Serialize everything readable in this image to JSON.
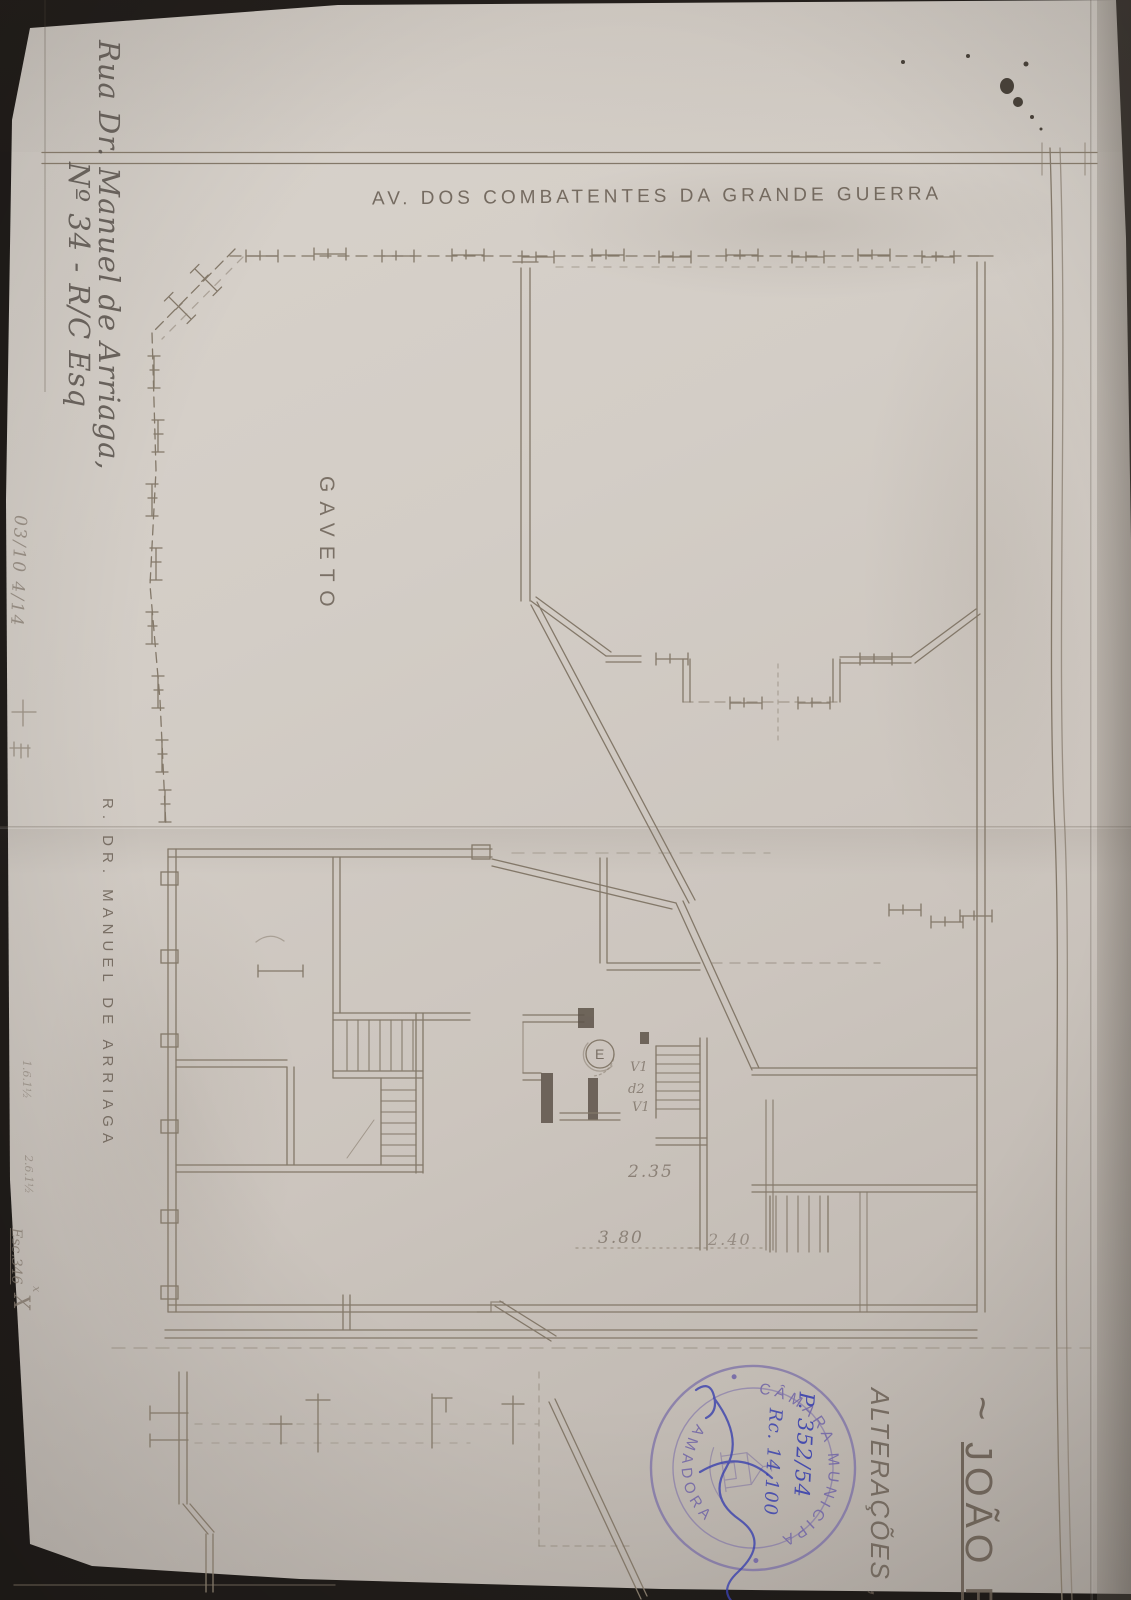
{
  "drawing": {
    "street_top": "AV. DOS COMBATENTES DA GRANDE GUERRA",
    "corner_label": "GAVETO",
    "street_left": "R. DR. MANUEL DE ARRIAGA",
    "room_labels": {
      "entry": "E",
      "window_top": "V1",
      "door_mid": "d2",
      "window_bottom": "V1"
    },
    "dimensions": {
      "hall": "2.35",
      "room": "3.80",
      "stair": "2.40"
    }
  },
  "handwriting": {
    "address_line1": "Rua Dr. Manuel de Arriaga,",
    "address_line2": "Nº 34 - R/C Esq",
    "margin_top_note": "03/10 4/14",
    "margin_note_1": "1.6.1½",
    "margin_note_2": "2.6.1½",
    "margin_scale_note": "Esc.346",
    "margin_mark": "X",
    "margin_mark_small": "x"
  },
  "titles": {
    "tilde": "~",
    "owner_name": "JOÃO RIC",
    "subtitle": "ALTERAÇÕES ,"
  },
  "stamp": {
    "ring_top": "CÂMARA MUNICIPAL DA",
    "ring_bottom": "AMADORA",
    "process_number": "P. 352/54",
    "register_number": "Rc. 14.100"
  },
  "colors": {
    "paper": "#d2cbc4",
    "pencil": "#857a6e",
    "ink_dark": "#5d5349",
    "stamp_purple": "#6f63a6",
    "pen_blue": "#3a41ae",
    "background": "#211d1a"
  }
}
